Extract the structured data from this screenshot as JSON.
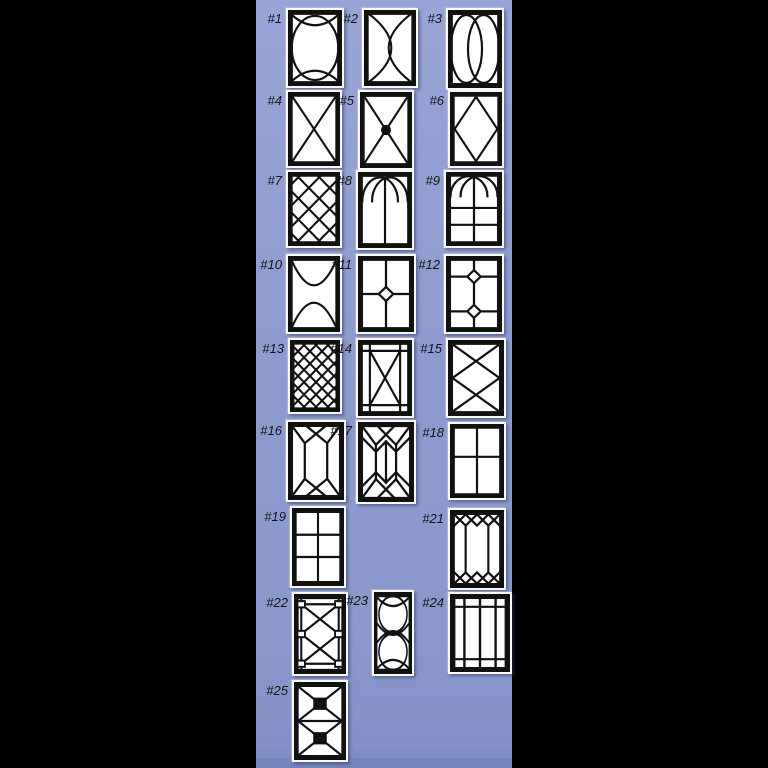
{
  "page": {
    "background_color": "#000000",
    "panel_color": "#8e9bcf",
    "panel_bottom_band_color": "#7585ba",
    "card_color": "#f9f9f9",
    "line_color": "#111111",
    "label_color": "#141414"
  },
  "catalog": {
    "items": [
      {
        "id": 1,
        "label": "#1",
        "design": "oval-with-crossing-arcs"
      },
      {
        "id": 2,
        "label": "#2",
        "design": "facing-crescent-curves"
      },
      {
        "id": 3,
        "label": "#3",
        "design": "overlapping-double-ovals"
      },
      {
        "id": 4,
        "label": "#4",
        "design": "diagonal-cross"
      },
      {
        "id": 5,
        "label": "#5",
        "design": "diagonal-cross-center-dot"
      },
      {
        "id": 6,
        "label": "#6",
        "design": "center-diamond"
      },
      {
        "id": 7,
        "label": "#7",
        "design": "large-diamond-lattice"
      },
      {
        "id": 8,
        "label": "#8",
        "design": "gothic-crossing-arches"
      },
      {
        "id": 9,
        "label": "#9",
        "design": "gothic-arch-over-grid"
      },
      {
        "id": 10,
        "label": "#10",
        "design": "crossing-bowl-and-dome-arcs"
      },
      {
        "id": 11,
        "label": "#11",
        "design": "cross-with-center-diamond"
      },
      {
        "id": 12,
        "label": "#12",
        "design": "double-diamond-grid"
      },
      {
        "id": 13,
        "label": "#13",
        "design": "dense-diamond-lattice"
      },
      {
        "id": 14,
        "label": "#14",
        "design": "bordered-x-with-corner-squares"
      },
      {
        "id": 15,
        "label": "#15",
        "design": "double-x-center-diamond"
      },
      {
        "id": 16,
        "label": "#16",
        "design": "emerald-facet-panel"
      },
      {
        "id": 17,
        "label": "#17",
        "design": "double-emerald-facet-panel"
      },
      {
        "id": 18,
        "label": "#18",
        "design": "two-by-two-grid"
      },
      {
        "id": 19,
        "label": "#19",
        "design": "two-by-three-grid"
      },
      {
        "id": 21,
        "label": "#21",
        "design": "diamond-band-with-side-mullions"
      },
      {
        "id": 22,
        "label": "#22",
        "design": "prairie-squares-double-x"
      },
      {
        "id": 23,
        "label": "#23",
        "design": "stacked-ovals-narrow"
      },
      {
        "id": 24,
        "label": "#24",
        "design": "prairie-border-grid"
      },
      {
        "id": 25,
        "label": "#25",
        "design": "stacked-bowtie-squares"
      }
    ]
  }
}
